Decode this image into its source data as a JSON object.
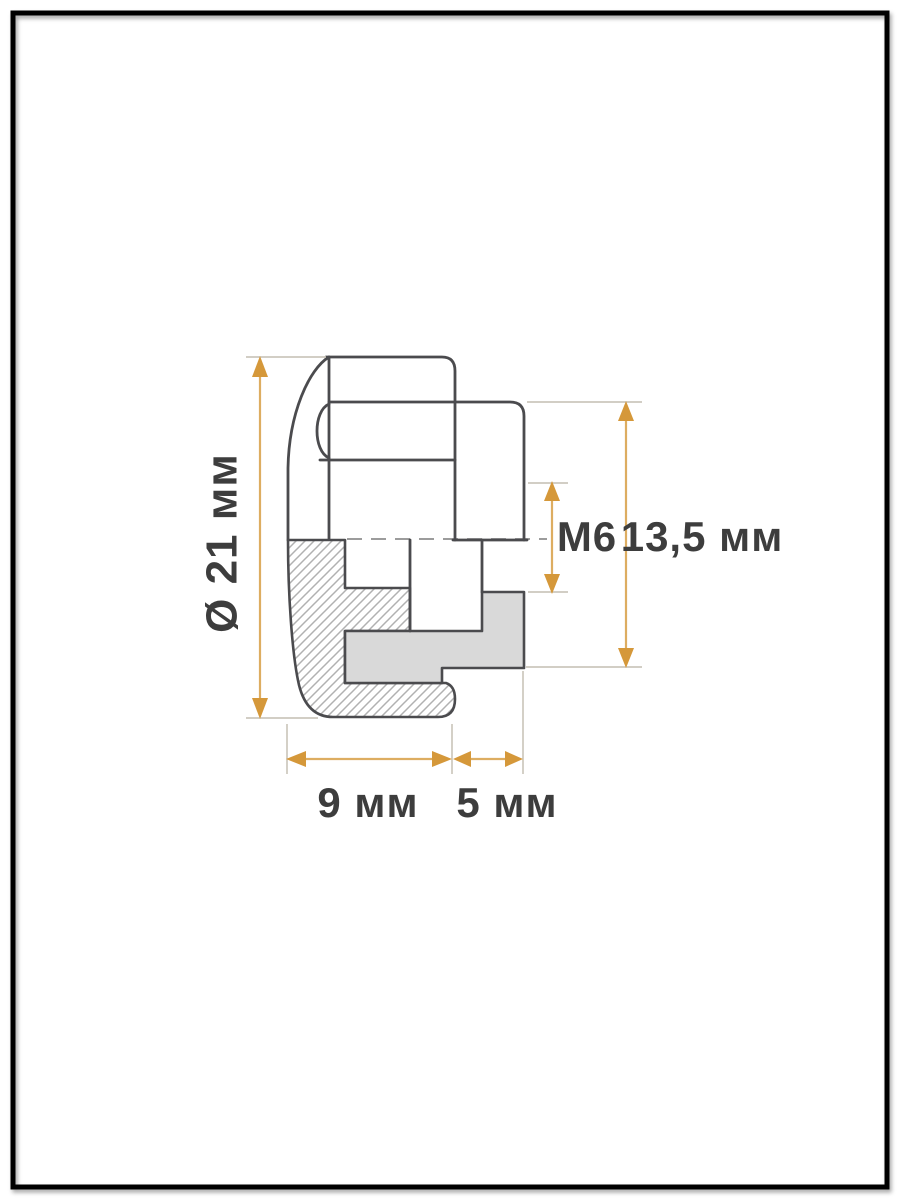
{
  "page": {
    "background": "#ffffff",
    "description": "Technical cross-section drawing of a threaded fitting (cap nut with seal) inside a black page frame"
  },
  "drawing": {
    "colors": {
      "background": "#ffffff",
      "frame": "#000000",
      "outline": "#4b4b4e",
      "extension_line": "#ccc7bd",
      "centerline": "#8f8f8f",
      "hatch_line": "#b1b1b1",
      "fill_gray": "#d9d9d9",
      "dimension_accent": "#d5983a",
      "text": "#3d3d3d"
    },
    "dimensions": [
      {
        "id": "overall-diameter",
        "label": "Ø 21 мм",
        "value": "21",
        "unit": "мм",
        "orientation": "vertical",
        "side": "left"
      },
      {
        "id": "thread-size",
        "label": "M6",
        "value": "M6",
        "orientation": "vertical",
        "side": "right-inner"
      },
      {
        "id": "flange-height",
        "label": "13,5 мм",
        "value": "13,5",
        "unit": "мм",
        "orientation": "vertical",
        "side": "right-outer"
      },
      {
        "id": "body-width",
        "label": "9 мм",
        "value": "9",
        "unit": "мм",
        "orientation": "horizontal",
        "side": "bottom-left"
      },
      {
        "id": "tail-width",
        "label": "5 мм",
        "value": "5",
        "unit": "мм",
        "orientation": "horizontal",
        "side": "bottom-right"
      }
    ]
  }
}
